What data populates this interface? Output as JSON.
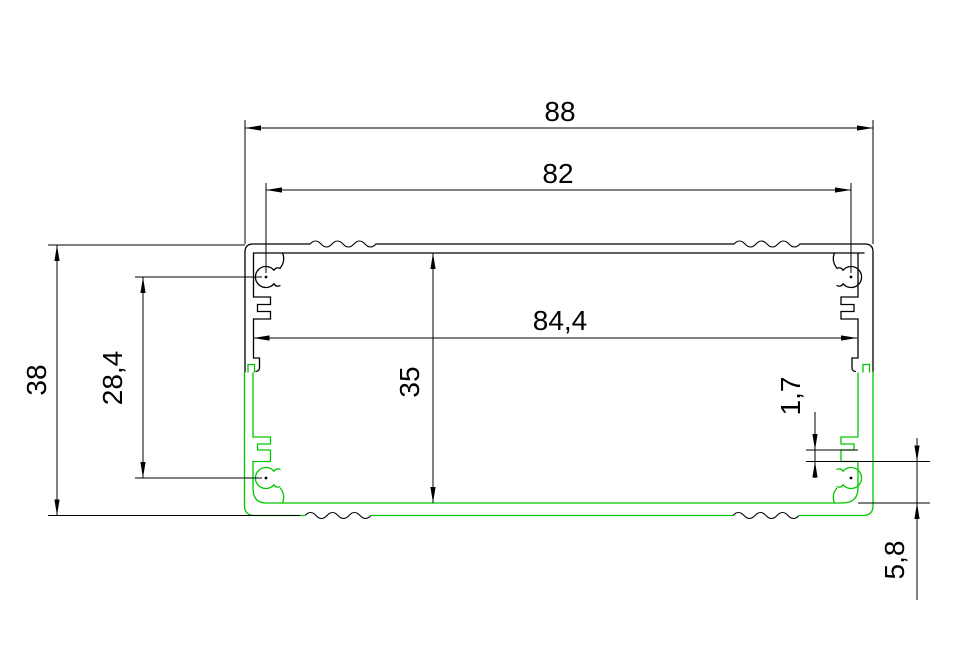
{
  "drawing": {
    "type": "cad-cross-section",
    "description": "Extruded aluminium enclosure profile cross-section, upper shell black, lower shell green",
    "background_color": "#ffffff",
    "upper_shell_color": "#000000",
    "lower_shell_color": "#00c800",
    "dimension_color": "#000000",
    "dimensions": {
      "overall_width": {
        "label": "88",
        "value": 88
      },
      "boss_center_width": {
        "label": "82",
        "value": 82
      },
      "interior_width": {
        "label": "84,4",
        "value": 84.4
      },
      "overall_height": {
        "label": "38",
        "value": 38
      },
      "boss_center_height": {
        "label": "28,4",
        "value": 28.4
      },
      "interior_height": {
        "label": "35",
        "value": 35
      },
      "slot_ledge_thickness": {
        "label": "1,7",
        "value": 1.7
      },
      "base_height": {
        "label": "5,8",
        "value": 5.8
      }
    }
  }
}
